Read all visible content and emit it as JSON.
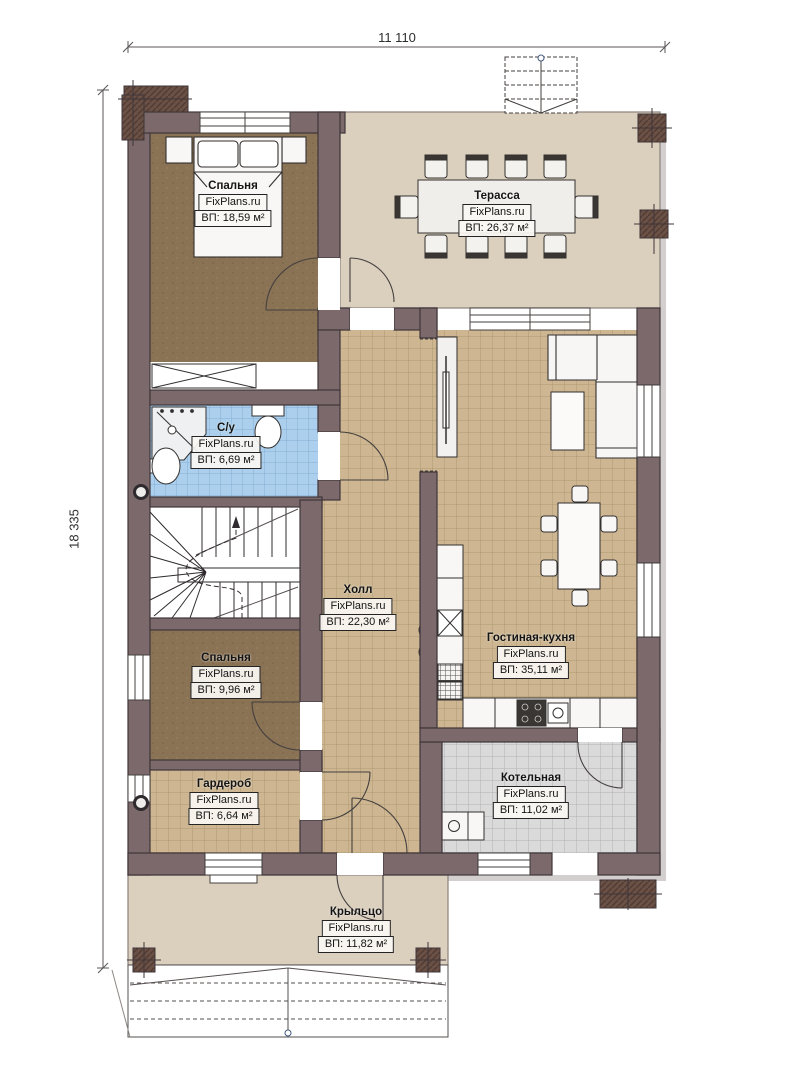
{
  "dimensions": {
    "width_label": "11 110",
    "height_label": "18 335"
  },
  "branding": {
    "site": "FixPlans.ru"
  },
  "rooms": [
    {
      "id": "bedroom-1",
      "name": "Спальня",
      "area": "ВП: 18,59 м²"
    },
    {
      "id": "bathroom",
      "name": "С/у",
      "area": "ВП: 6,69 м²"
    },
    {
      "id": "hall",
      "name": "Холл",
      "area": "ВП: 22,30 м²"
    },
    {
      "id": "terrace",
      "name": "Терасса",
      "area": "ВП: 26,37 м²"
    },
    {
      "id": "living-kitchen",
      "name": "Гостиная-кухня",
      "area": "ВП: 35,11 м²"
    },
    {
      "id": "bedroom-2",
      "name": "Спальня",
      "area": "ВП: 9,96 м²"
    },
    {
      "id": "wardrobe",
      "name": "Гардероб",
      "area": "ВП: 6,64 м²"
    },
    {
      "id": "boiler-room",
      "name": "Котельная",
      "area": "ВП: 11,02 м²"
    },
    {
      "id": "porch",
      "name": "Крыльцо",
      "area": "ВП: 11,82 м²"
    }
  ],
  "colors": {
    "wall": "#7b696b",
    "wall_outline": "#3f363a",
    "floor_tan": "#cdb691",
    "floor_brown": "#8a7254",
    "floor_blue": "#abcfec",
    "floor_gray": "#dadada",
    "floor_beige": "#dbcfbe",
    "chimney": "#6b5046",
    "line": "#33302f"
  }
}
